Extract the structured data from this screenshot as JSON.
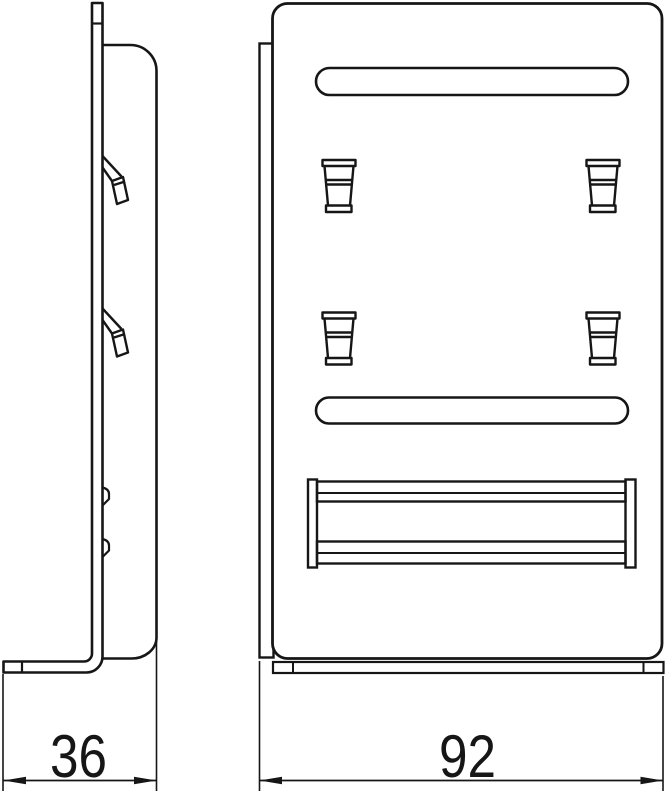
{
  "drawing": {
    "kind": "technical-drawing-two-views",
    "views": {
      "left": "side-view",
      "right": "front-view"
    },
    "dimension_labels": {
      "depth": "36",
      "width": "92"
    },
    "line_color": "#161616",
    "background_color": "#ffffff"
  }
}
